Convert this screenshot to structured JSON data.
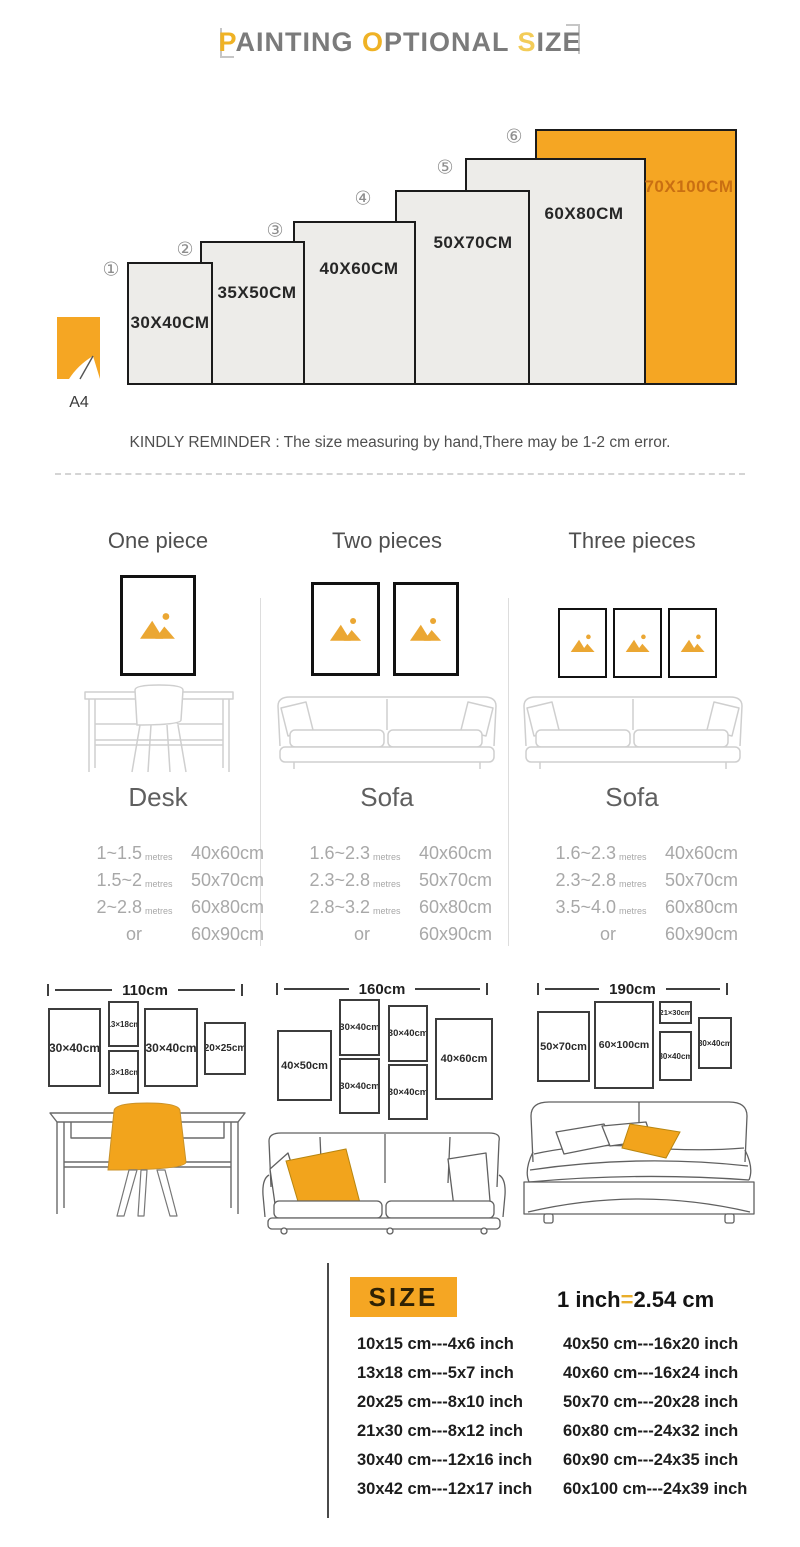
{
  "colors": {
    "accent": "#F5A623",
    "highlight_label": "#C96F12",
    "title_gray": "#7B7B7B"
  },
  "title": {
    "h1": "P",
    "t1": "AINTING ",
    "h2": "O",
    "t2": "PTIONAL ",
    "h3": "S",
    "t3": "IZE"
  },
  "size_chart": {
    "bars": [
      {
        "num": "①",
        "label": "30X40CM"
      },
      {
        "num": "②",
        "label": "35X50CM"
      },
      {
        "num": "③",
        "label": "40X60CM"
      },
      {
        "num": "④",
        "label": "50X70CM"
      },
      {
        "num": "⑤",
        "label": "60X80CM"
      },
      {
        "num": "⑥",
        "label": "70X100CM"
      }
    ],
    "a4_label": "A4",
    "reminder": "KINDLY REMINDER : The size measuring by hand,There may be 1-2 cm error."
  },
  "pieces": {
    "columns": [
      {
        "header": "One piece",
        "furniture_label": "Desk",
        "rows": [
          {
            "range": "1~1.5",
            "unit": "metres",
            "size": "40x60cm"
          },
          {
            "range": "1.5~2",
            "unit": "metres",
            "size": "50x70cm"
          },
          {
            "range": "2~2.8",
            "unit": "metres",
            "size": "60x80cm"
          },
          {
            "range": "or",
            "unit": "",
            "size": "60x90cm"
          }
        ]
      },
      {
        "header": "Two pieces",
        "furniture_label": "Sofa",
        "rows": [
          {
            "range": "1.6~2.3",
            "unit": "metres",
            "size": "40x60cm"
          },
          {
            "range": "2.3~2.8",
            "unit": "metres",
            "size": "50x70cm"
          },
          {
            "range": "2.8~3.2",
            "unit": "metres",
            "size": "60x80cm"
          },
          {
            "range": "or",
            "unit": "",
            "size": "60x90cm"
          }
        ]
      },
      {
        "header": "Three pieces",
        "furniture_label": "Sofa",
        "rows": [
          {
            "range": "1.6~2.3",
            "unit": "metres",
            "size": "40x60cm"
          },
          {
            "range": "2.3~2.8",
            "unit": "metres",
            "size": "50x70cm"
          },
          {
            "range": "3.5~4.0",
            "unit": "metres",
            "size": "60x80cm"
          },
          {
            "range": "or",
            "unit": "",
            "size": "60x90cm"
          }
        ]
      }
    ]
  },
  "layouts": [
    {
      "width_label": "110cm",
      "frames": [
        "30×40cm",
        "13×18cm",
        "13×18cm",
        "30×40cm",
        "20×25cm"
      ]
    },
    {
      "width_label": "160cm",
      "frames": [
        "40×50cm",
        "30×40cm",
        "30×40cm",
        "30×40cm",
        "30×40cm",
        "40×60cm"
      ]
    },
    {
      "width_label": "190cm",
      "frames": [
        "50×70cm",
        "60×100cm",
        "21×30cm",
        "30×40cm",
        "30×40cm"
      ]
    }
  ],
  "size_table": {
    "badge": "SIZE",
    "equation": {
      "lhs": "1 inch",
      "eq": "=",
      "rhs": "2.54 cm"
    },
    "left": [
      "10x15 cm---4x6 inch",
      "13x18 cm---5x7 inch",
      "20x25 cm---8x10 inch",
      "21x30 cm---8x12 inch",
      "30x40 cm---12x16 inch",
      "30x42 cm---12x17 inch"
    ],
    "right": [
      "40x50 cm---16x20 inch",
      "40x60 cm---16x24 inch",
      "50x70 cm---20x28 inch",
      "60x80 cm---24x32 inch",
      "60x90 cm---24x35 inch",
      "60x100 cm---24x39 inch"
    ]
  }
}
